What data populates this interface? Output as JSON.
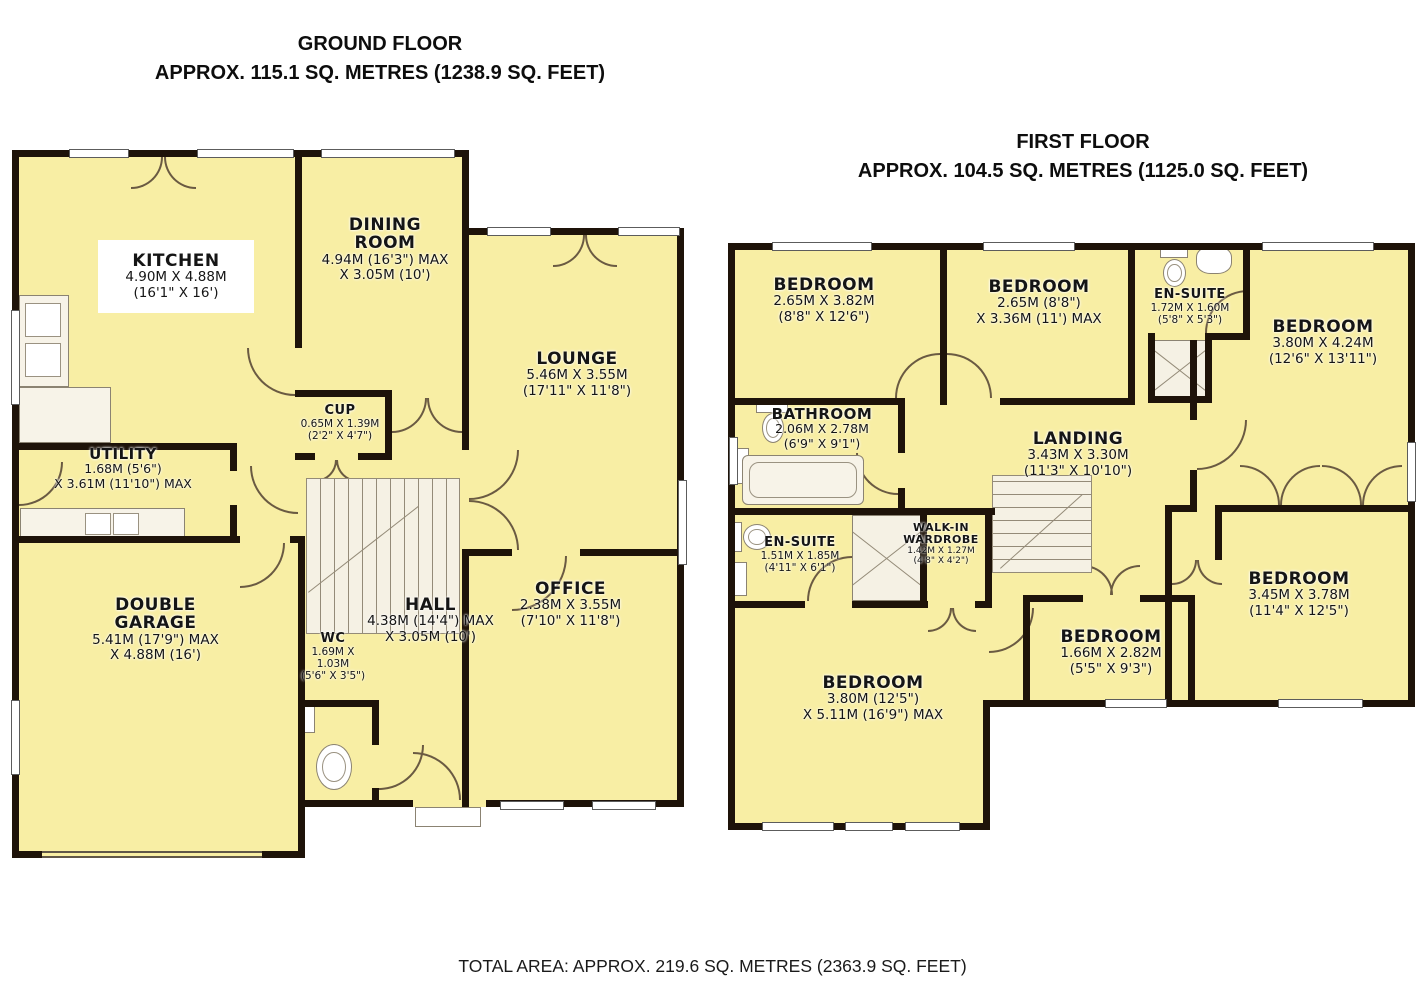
{
  "ground_floor": {
    "title": "GROUND FLOOR",
    "subtitle": "APPROX. 115.1 SQ. METRES (1238.9 SQ. FEET)",
    "rooms": {
      "kitchen": {
        "name": "KITCHEN",
        "metric": "4.90M X 4.88M",
        "imperial": "(16'1\" X 16')"
      },
      "dining_room": {
        "name": "DINING\nROOM",
        "metric": "4.94M (16'3\") MAX",
        "imperial": "X 3.05M (10')"
      },
      "lounge": {
        "name": "LOUNGE",
        "metric": "5.46M X 3.55M",
        "imperial": "(17'11\" X 11'8\")"
      },
      "cup": {
        "name": "CUP",
        "metric": "0.65M X 1.39M",
        "imperial": "(2'2\" X 4'7\")"
      },
      "utility": {
        "name": "UTILITY",
        "metric": "1.68M (5'6\")",
        "imperial": "X 3.61M (11'10\") MAX"
      },
      "double_garage": {
        "name": "DOUBLE\nGARAGE",
        "metric": "5.41M (17'9\") MAX",
        "imperial": "X 4.88M (16')"
      },
      "wc": {
        "name": "WC",
        "metric": "1.69M X 1.03M",
        "imperial": "(5'6\" X 3'5\")"
      },
      "hall": {
        "name": "HALL",
        "metric": "4.38M (14'4\") MAX",
        "imperial": "X 3.05M (10')"
      },
      "office": {
        "name": "OFFICE",
        "metric": "2.38M X 3.55M",
        "imperial": "(7'10\" X 11'8\")"
      }
    }
  },
  "first_floor": {
    "title": "FIRST FLOOR",
    "subtitle": "APPROX. 104.5 SQ. METRES (1125.0 SQ. FEET)",
    "rooms": {
      "bedroom_top_left": {
        "name": "BEDROOM",
        "metric": "2.65M X 3.82M",
        "imperial": "(8'8\" X 12'6\")"
      },
      "bedroom_top_middle": {
        "name": "BEDROOM",
        "metric": "2.65M (8'8\")",
        "imperial": "X 3.36M (11') MAX"
      },
      "en_suite_top": {
        "name": "EN-SUITE",
        "metric": "1.72M X 1.60M",
        "imperial": "(5'8\" X 5'3\")"
      },
      "bedroom_right": {
        "name": "BEDROOM",
        "metric": "3.80M X 4.24M",
        "imperial": "(12'6\" X 13'11\")"
      },
      "bathroom": {
        "name": "BATHROOM",
        "metric": "2.06M X 2.78M",
        "imperial": "(6'9\" X 9'1\")"
      },
      "landing": {
        "name": "LANDING",
        "metric": "3.43M X 3.30M",
        "imperial": "(11'3\" X 10'10\")"
      },
      "en_suite_left": {
        "name": "EN-SUITE",
        "metric": "1.51M X 1.85M",
        "imperial": "(4'11\" X 6'1\")"
      },
      "walk_in_wardrobe": {
        "name": "WALK-IN\nWARDROBE",
        "metric": "1.42M X 1.27M",
        "imperial": "(4'8\" X 4'2\")"
      },
      "bedroom_bottom_left": {
        "name": "BEDROOM",
        "metric": "3.80M (12'5\")",
        "imperial": "X 5.11M (16'9\") MAX"
      },
      "bedroom_bottom_middle": {
        "name": "BEDROOM",
        "metric": "1.66M X 2.82M",
        "imperial": "(5'5\" X 9'3\")"
      },
      "bedroom_bottom_right": {
        "name": "BEDROOM",
        "metric": "3.45M X 3.78M",
        "imperial": "(11'4\" X 12'5\")"
      }
    }
  },
  "footer": {
    "total_area": "TOTAL AREA: APPROX. 219.6 SQ. METRES (2363.9 SQ. FEET)"
  },
  "colors": {
    "room_fill": "#F8EEA4",
    "wall": "#1E1309",
    "background": "#FFFFFF"
  }
}
